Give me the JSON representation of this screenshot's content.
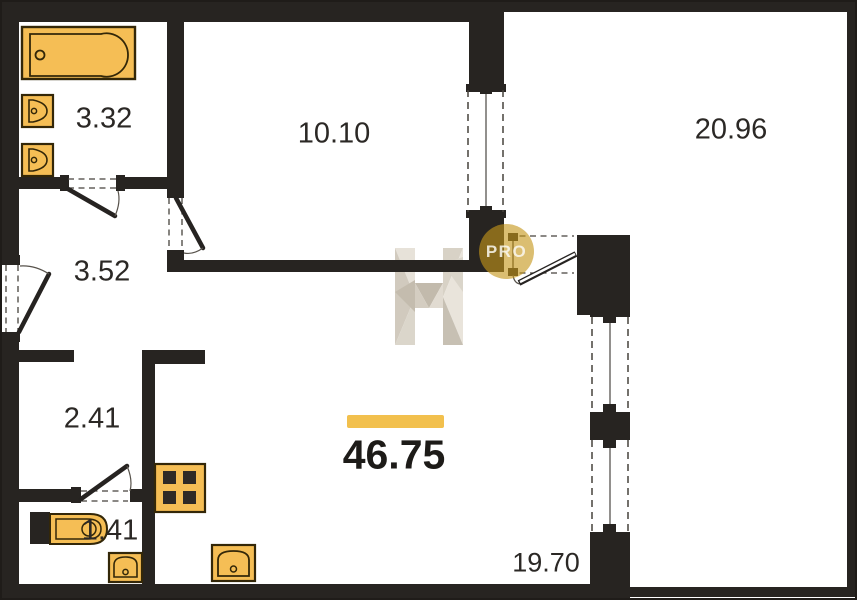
{
  "plan_title": "apartment-floor-plan",
  "rooms": {
    "bathroom": "3.32",
    "bedroom": "10.10",
    "terrace": "20.96",
    "hallway": "3.52",
    "corridor": "2.41",
    "wc": "1.41",
    "living_kitchen": "19.70"
  },
  "total_area": "46.75",
  "badge": {
    "label": "PRO"
  },
  "watermark": {
    "logo_letter": "N-faceted-logo"
  },
  "colors": {
    "wall": "#272421",
    "fixture_fill": "#F5BE55",
    "fixture_stroke": "#332708",
    "accent_bar": "#F2C04D",
    "badge_gold": "#C5961A",
    "watermark_light": "#E6E1D8",
    "watermark_dark": "#C5BDAF"
  },
  "fixtures": [
    "bathtub-icon",
    "sink-icon",
    "sink-icon",
    "toilet-icon",
    "sink-icon",
    "stove-icon",
    "sink-icon"
  ]
}
